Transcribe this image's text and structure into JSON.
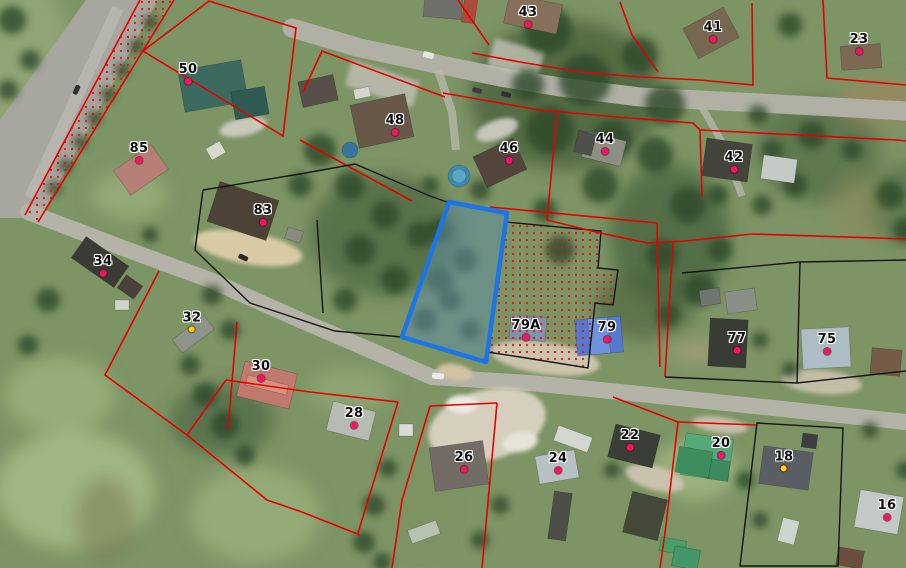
{
  "map": {
    "type": "cadastral-satellite-view",
    "selected_parcel": {
      "outline_color": "#1b74e8",
      "fill_color": "#5e8da0"
    },
    "boundary_colors": {
      "red": "#e60000",
      "black": "#151515",
      "stipple_dot": "#e81010"
    },
    "marker_colors": {
      "pink": "#ee1860",
      "yellow": "#ffd800"
    },
    "parcel_labels": [
      {
        "text": "50",
        "x": 188,
        "y": 73,
        "dot": "pink"
      },
      {
        "text": "85",
        "x": 139,
        "y": 152,
        "dot": "pink"
      },
      {
        "text": "43",
        "x": 528,
        "y": 16,
        "dot": "pink"
      },
      {
        "text": "41",
        "x": 713,
        "y": 31,
        "dot": "pink"
      },
      {
        "text": "23",
        "x": 859,
        "y": 43,
        "dot": "pink"
      },
      {
        "text": "48",
        "x": 395,
        "y": 124,
        "dot": "pink"
      },
      {
        "text": "46",
        "x": 509,
        "y": 152,
        "dot": "pink"
      },
      {
        "text": "44",
        "x": 605,
        "y": 143,
        "dot": "pink"
      },
      {
        "text": "42",
        "x": 734,
        "y": 161,
        "dot": "pink"
      },
      {
        "text": "83",
        "x": 263,
        "y": 214,
        "dot": "pink"
      },
      {
        "text": "34",
        "x": 103,
        "y": 265,
        "dot": "pink"
      },
      {
        "text": "32",
        "x": 192,
        "y": 321,
        "dot": "yellow"
      },
      {
        "text": "30",
        "x": 261,
        "y": 370,
        "dot": "pink"
      },
      {
        "text": "28",
        "x": 354,
        "y": 417,
        "dot": "pink"
      },
      {
        "text": "79A",
        "x": 526,
        "y": 329,
        "dot": "pink"
      },
      {
        "text": "79",
        "x": 607,
        "y": 331,
        "dot": "pink"
      },
      {
        "text": "77",
        "x": 737,
        "y": 342,
        "dot": "pink"
      },
      {
        "text": "75",
        "x": 827,
        "y": 343,
        "dot": "pink"
      },
      {
        "text": "26",
        "x": 464,
        "y": 461,
        "dot": "pink"
      },
      {
        "text": "24",
        "x": 558,
        "y": 462,
        "dot": "pink"
      },
      {
        "text": "22",
        "x": 630,
        "y": 439,
        "dot": "pink"
      },
      {
        "text": "20",
        "x": 721,
        "y": 447,
        "dot": "pink"
      },
      {
        "text": "18",
        "x": 784,
        "y": 460,
        "dot": "yellow"
      },
      {
        "text": "16",
        "x": 887,
        "y": 509,
        "dot": "pink"
      }
    ]
  }
}
